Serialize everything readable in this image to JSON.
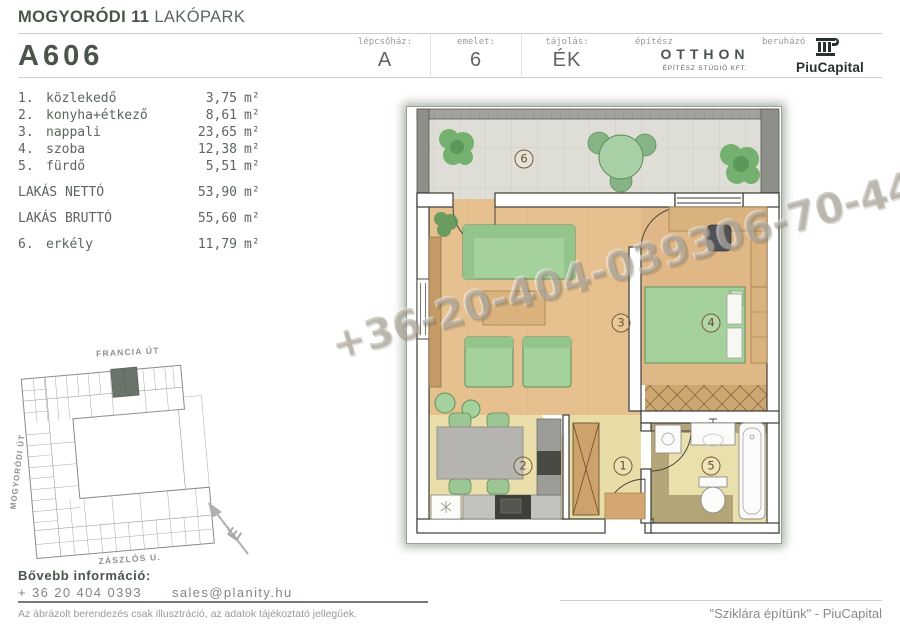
{
  "header": {
    "project_bold": "MOGYORÓDI 11",
    "project_light": " LAKÓPARK",
    "unit_code": "A606",
    "meta": [
      {
        "label": "lépcsőház:",
        "value": "A"
      },
      {
        "label": "emelet:",
        "value": "6"
      },
      {
        "label": "tájolás:",
        "value": "ÉK"
      }
    ],
    "architect": {
      "label": "építész",
      "name": "OTTHON",
      "sub": "ÉPÍTÉSZ STÚDIÓ KFT."
    },
    "developer": {
      "label": "beruházó",
      "name": "PiuCapital"
    }
  },
  "rooms": {
    "items": [
      {
        "num": "1.",
        "name": "közlekedő",
        "value": "3,75",
        "unit": "m²"
      },
      {
        "num": "2.",
        "name": "konyha+étkező",
        "value": "8,61",
        "unit": "m²"
      },
      {
        "num": "3.",
        "name": "nappali",
        "value": "23,65",
        "unit": "m²"
      },
      {
        "num": "4.",
        "name": "szoba",
        "value": "12,38",
        "unit": "m²"
      },
      {
        "num": "5.",
        "name": "fürdő",
        "value": "5,51",
        "unit": "m²"
      }
    ],
    "totals": [
      {
        "label": "LAKÁS NETTÓ",
        "value": "53,90",
        "unit": "m²"
      },
      {
        "label": "LAKÁS BRUTTÓ",
        "value": "55,60",
        "unit": "m²"
      }
    ],
    "extra": {
      "num": "6.",
      "name": "erkély",
      "value": "11,79",
      "unit": "m²"
    }
  },
  "plan": {
    "labels": [
      "1",
      "2",
      "3",
      "4",
      "5",
      "6"
    ],
    "watermark": "+36-20-404-039306-70-44"
  },
  "site": {
    "streets": [
      "FRANCIA ÚT",
      "MOGYORÓDI ÚT",
      "ZÁSZLÓS U."
    ],
    "north": "É"
  },
  "footer": {
    "info_label": "Bővebb információ:",
    "phone": "+ 36 20 404 0393",
    "email": "sales@planity.hu",
    "disclaimer": "Az ábrázolt berendezés csak illusztráció, az adatok tájékoztató jellegűek.",
    "quote": "\"Sziklára építünk\" - PiuCapital"
  }
}
